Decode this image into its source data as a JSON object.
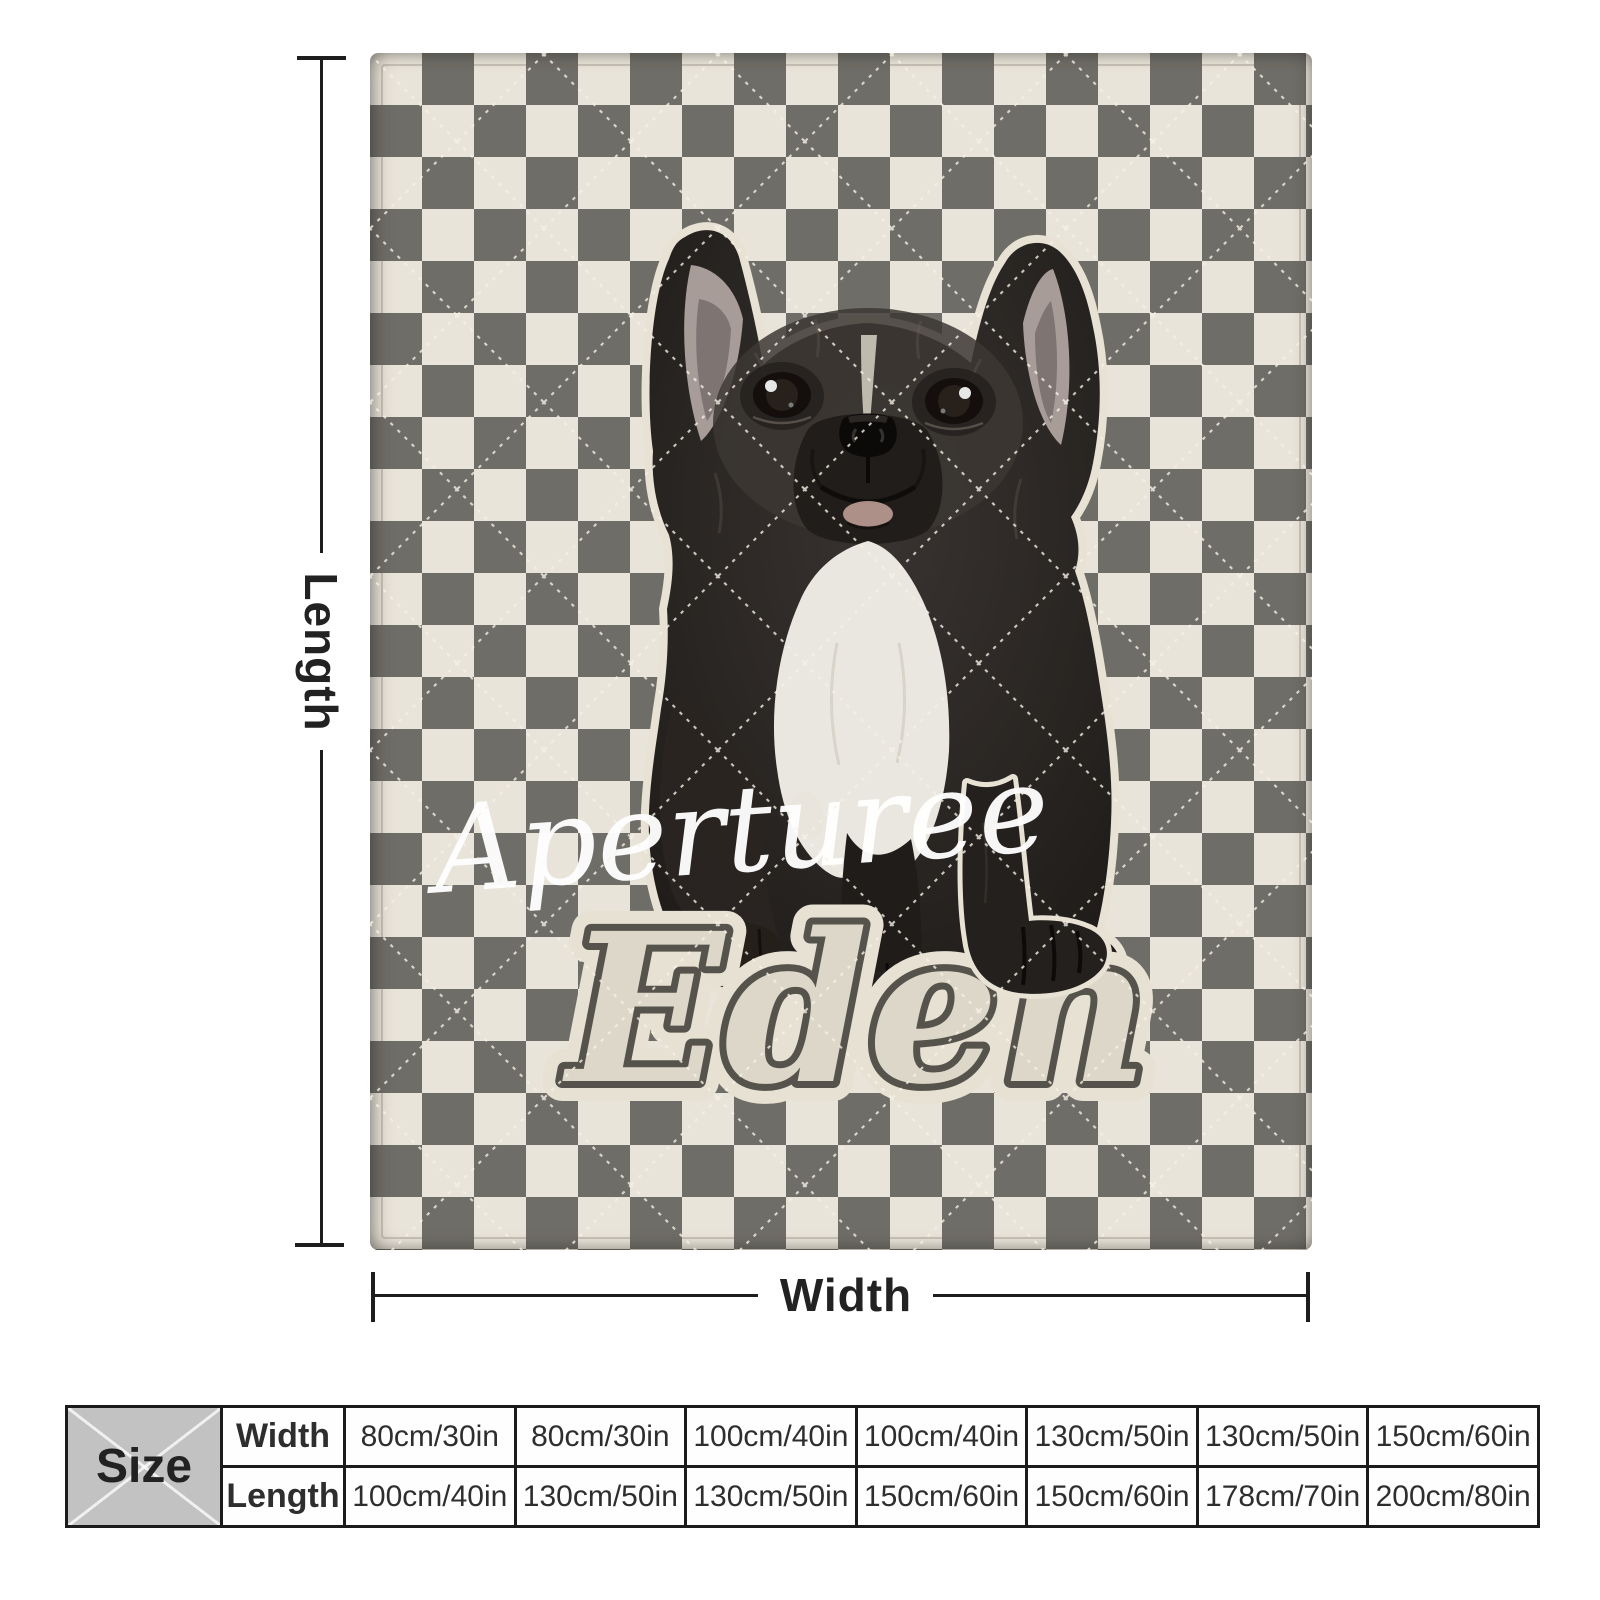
{
  "branding": {
    "watermark": "Aperturee"
  },
  "blanket": {
    "pet_name": "Eden",
    "description": "checkered quilted blanket with french bulldog puppy photo",
    "colors": {
      "checker_dark": "#6f6d67",
      "checker_light": "#e9e4d9",
      "name_fill": "#dcd7c9",
      "name_outline": "#55534b",
      "sticker_outline": "#e8e2d4"
    }
  },
  "dimensions": {
    "length_label": "Length",
    "width_label": "Width"
  },
  "size_table": {
    "corner_label": "Size",
    "row_labels": [
      "Width",
      "Length"
    ],
    "widths": [
      "80cm/30in",
      "80cm/30in",
      "100cm/40in",
      "100cm/40in",
      "130cm/50in",
      "130cm/50in",
      "150cm/60in"
    ],
    "lengths": [
      "100cm/40in",
      "130cm/50in",
      "130cm/50in",
      "150cm/60in",
      "150cm/60in",
      "178cm/70in",
      "200cm/80in"
    ]
  }
}
